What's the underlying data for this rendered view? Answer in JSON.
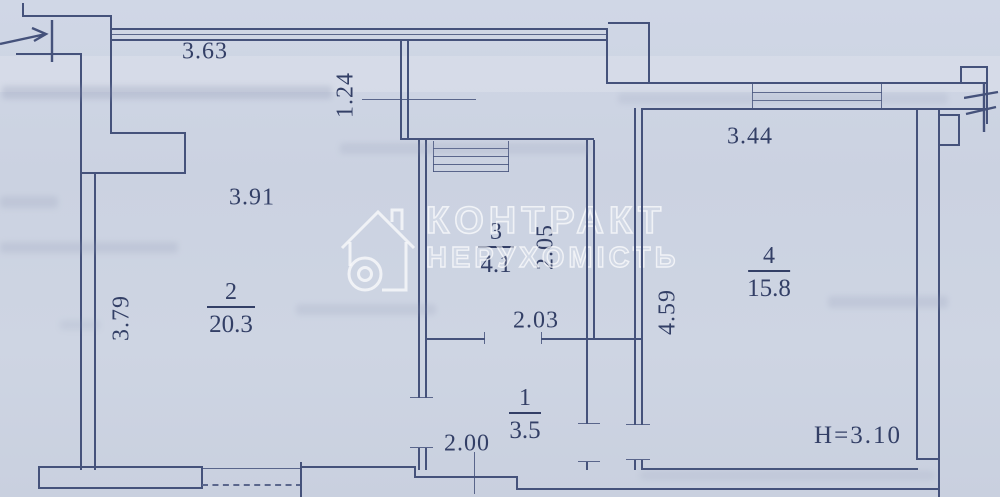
{
  "plan": {
    "watermark": {
      "line1": "КОНТРАКТ",
      "line2": "НЕРУХОМІСТЬ",
      "logo": "house-keyhole-icon"
    },
    "ceiling_height_label": "H=3.10",
    "rooms": [
      {
        "number": "1",
        "area": "3.5"
      },
      {
        "number": "2",
        "area": "20.3"
      },
      {
        "number": "3",
        "area": "4.1"
      },
      {
        "number": "4",
        "area": "15.8"
      }
    ],
    "dimensions": {
      "top_window_width": "3.63",
      "upper_partition_depth": "1.24",
      "room2_width": "3.91",
      "room2_depth": "3.79",
      "room3_width": "2.03",
      "room3_depth": "2.05",
      "room4_width": "3.44",
      "room4_depth": "4.59",
      "room1_width": "2.00"
    }
  }
}
